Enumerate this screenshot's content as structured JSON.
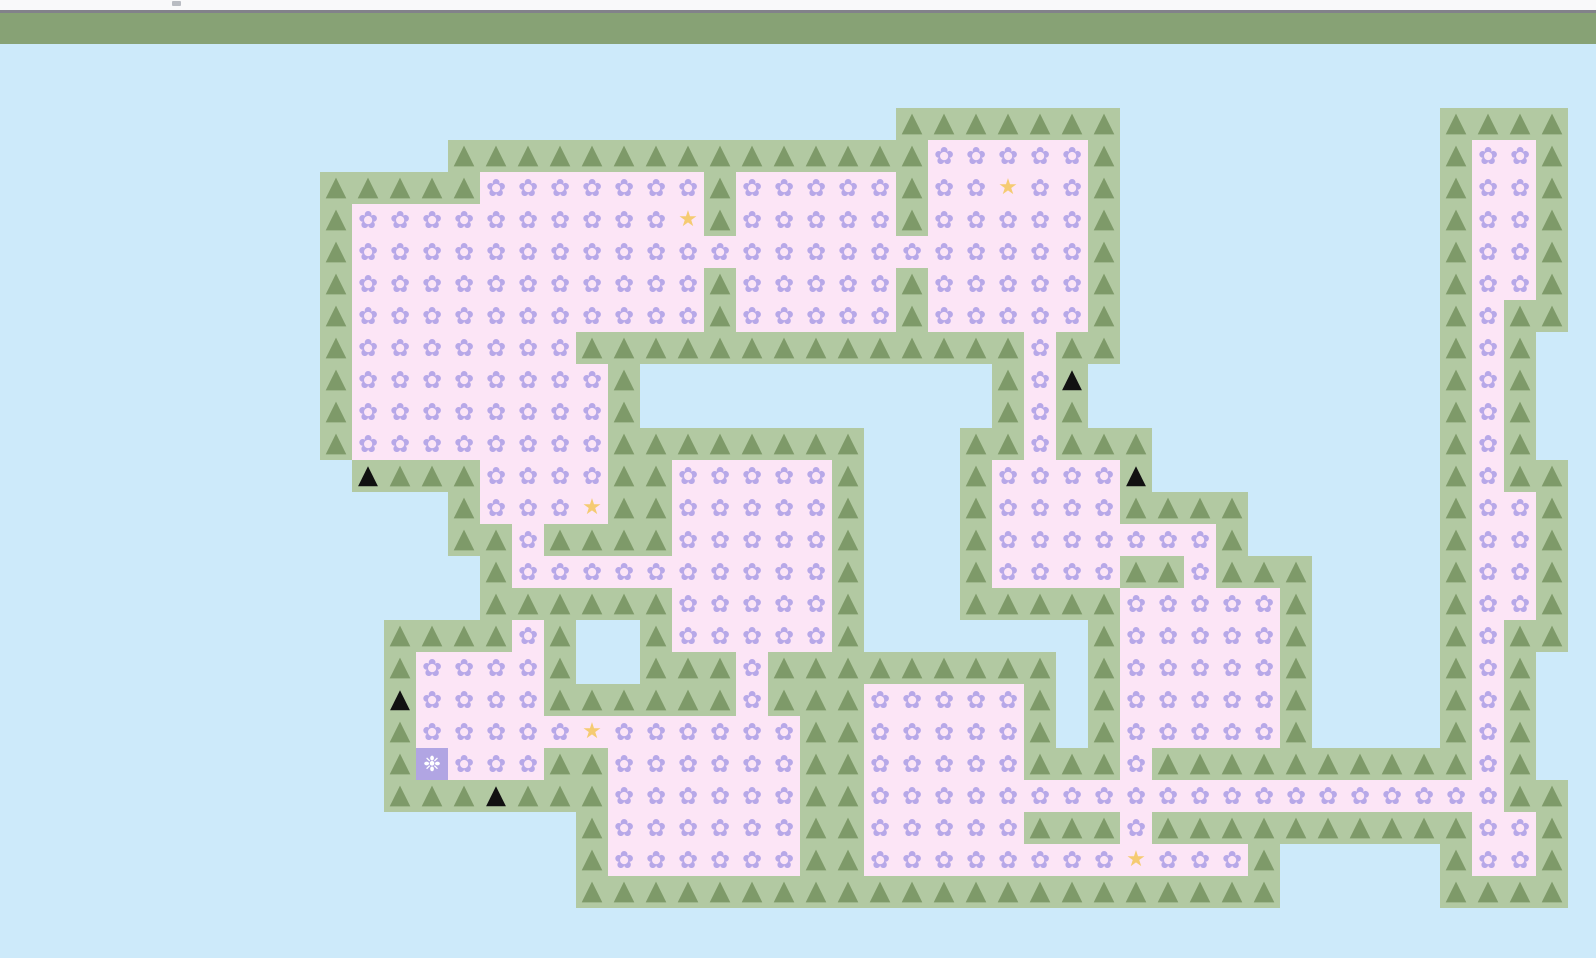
{
  "page": {
    "top_strip_color": "#f9f9fa",
    "divider_color": "#82828a",
    "header_color": "#87a275",
    "sky_color": "#cdeafa"
  },
  "board": {
    "tile_size": 32,
    "origin_y": 44,
    "cols": 50,
    "rows": 29,
    "colors": {
      "ground": "#b2c9a2",
      "tree": "#7e9a69",
      "field": "#fce5f6",
      "flower": "#b7a8e8",
      "star": "#f5cb72",
      "black_triangle": "#111111",
      "player_bg": "#b1a5e3",
      "player_glyph": "#ffffff"
    },
    "legend": {
      "T": {
        "name": "tree-tile",
        "icon": "tree-icon",
        "glyph": "▲",
        "bg": "ground",
        "glyph_class": "glyph-tree",
        "interactable": "false"
      },
      "F": {
        "name": "flower-tile",
        "icon": "flower-icon",
        "glyph": "✿",
        "bg": "field",
        "glyph_class": "glyph-flower",
        "interactable": "false"
      },
      "S": {
        "name": "star-tile",
        "icon": "star-icon",
        "glyph": "★",
        "bg": "field",
        "glyph_class": "glyph-star",
        "interactable": "false"
      },
      "K": {
        "name": "black-triangle-tile",
        "icon": "black-triangle-icon",
        "glyph": "▲",
        "bg": "ground",
        "glyph_class": "glyph-black",
        "interactable": "false"
      },
      "P": {
        "name": "player-tile",
        "icon": "player-flower-icon",
        "glyph": "❉",
        "bg": "player",
        "glyph_class": "glyph-player",
        "interactable": "true"
      }
    },
    "grid": [
      "..................................................",
      "..................................................",
      "............................TTTTTTT..........TTTT.",
      "..............TTTTTTTTTTTTTTTFFFFFT..........TFFT.",
      "..........TTTTTFFFFFFFTFFFFFTFFSFFT..........TFFT.",
      "..........TFFFFFFFFFFSTFFFFFTFFFFFT..........TFFT.",
      "..........TFFFFFFFFFFFFFFFFFFFFFFFT..........TFFT.",
      "..........TFFFFFFFFFFFTFFFFFTFFFFFT..........TFFT.",
      "..........TFFFFFFFFFFFTFFFFFTFFFFFT..........TFTT.",
      "..........TFFFFFFFTTTTTTTTTTTTTTFTT..........TFT..",
      "..........TFFFFFFFFT...........TFK...........TFT..",
      "..........TFFFFFFFFT...........TFT...........TFT..",
      "..........TFFFFFFFFTTTTTTTT...TTFTTT.........TFT..",
      "...........KTTTFFFFTTFFFFFT...TFFFFK.........TFTT.",
      "..............TFFFSTTFFFFFT...TFFFFTTTT......TFFT.",
      "..............TTFTTTTFFFFFT...TFFFFFFFT......TFFT.",
      "...............TFFFFFFFFFFT...TFFFFTTFTTT....TFFT.",
      "...............TTTTTTFFFFFT...TTTTTFFFFFT....TFFT.",
      "............TTTTFT..TFFFFFT.......TFFFFFT....TFTT.",
      "............TFFFFT..TTTFTTTTTTTTT.TFFFFFT....TFT..",
      "............KFFFFTTTTTTFTTTFFFFFT.TFFFFFT....TFT..",
      "............TFFFFFSFFFFFFTTFFFFFT.TFFFFFT....TFT..",
      "............TPFFFTTFFFFFFTTFFFFFTTTFTTTTTTTTTTFT..",
      "............TTTKTTTFFFFFFTTFFFFFFFFFFFFFFFFFFFFTT.",
      "..................TFFFFFFTTFFFFFTTTFTTTTTTTTTTFFT.",
      "..................TFFFFFFTTFFFFFFFFSFFFT.....TFFT.",
      "..................TTTTTTTTTTTTTTTTTTTTTT.....TTTT.",
      "..................................................",
      ".................................................."
    ]
  }
}
